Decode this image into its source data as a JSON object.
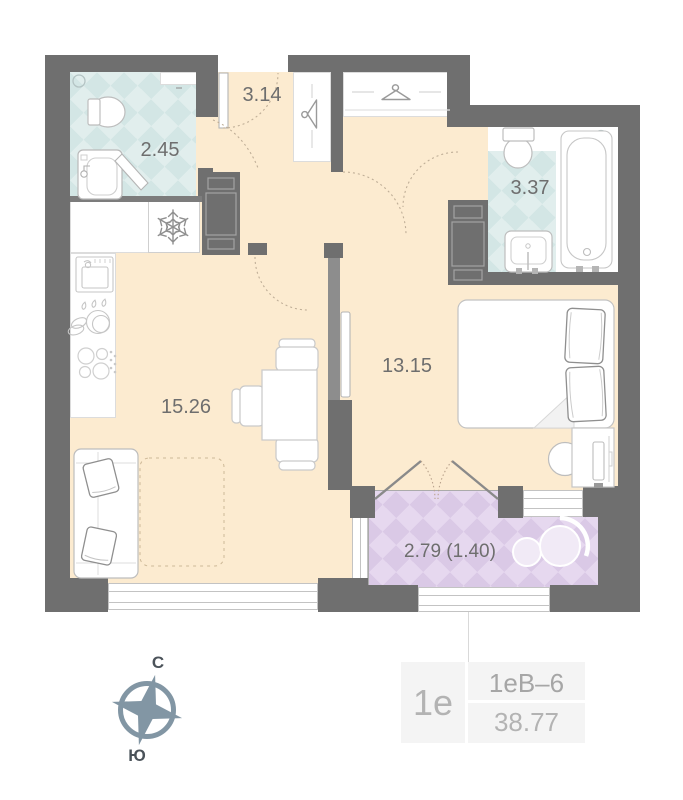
{
  "floor_plan": {
    "rooms": [
      {
        "name": "bathroom-small",
        "area": "2.45"
      },
      {
        "name": "hallway",
        "area": "3.14"
      },
      {
        "name": "bathroom-large",
        "area": "3.37"
      },
      {
        "name": "bedroom",
        "area": "13.15"
      },
      {
        "name": "kitchen-living-room",
        "area": "15.26"
      },
      {
        "name": "balcony",
        "area": "2.79 (1.40)"
      }
    ],
    "compass": {
      "north_label": "С",
      "south_label": "Ю"
    },
    "info_card": {
      "unit_type": "1е",
      "layout_code": "1еВ–6",
      "total_area": "38.77"
    },
    "colors": {
      "wall": "#6f6f6f",
      "floor": "#fcebd0",
      "tile_bathroom": "#d3e6e5",
      "tile_balcony": "#dac9e6",
      "label_text": "#6e6e6e",
      "compass": "#8296a4"
    }
  }
}
